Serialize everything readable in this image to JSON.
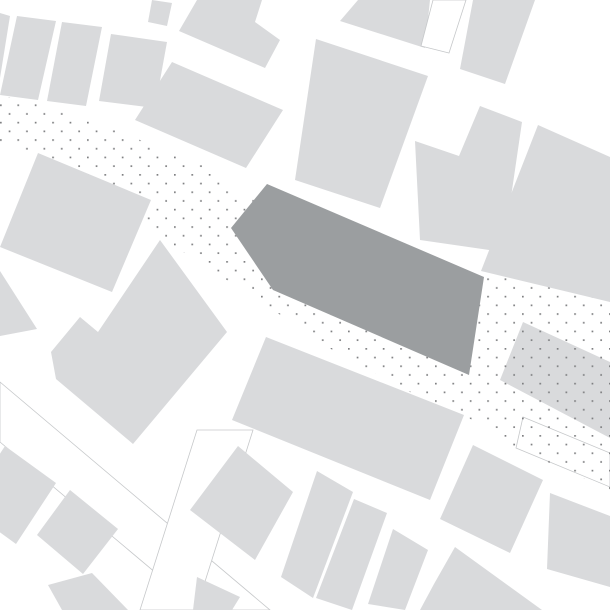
{
  "map": {
    "canvas": {
      "width": 610,
      "height": 610,
      "background": "#ffffff"
    },
    "colors": {
      "building_fill": "#d9dadc",
      "highlight_fill": "#9b9ea0",
      "outline_stroke": "#c6c8ca",
      "dot_color": "#7f8082",
      "background": "#ffffff"
    },
    "dot_pattern": {
      "cell_size": 17.4,
      "dot_size": 1.7,
      "stagger_offset": 8.7
    },
    "dotted_band": {
      "points": "0,95 70,112 140,140 205,166 232,190 480,272 610,293 610,490 516,448 464,415 410,392 340,355 270,308 160,237 130,215 70,168 0,143"
    },
    "highlight_building": {
      "id": "highlighted-building",
      "points": "267,184 484,277 469,375 273,290 231,228"
    },
    "dotted_building": {
      "id": "dotted-surface-building",
      "points": "523,322 610,362 610,438 500,380"
    },
    "outlined_white_building": {
      "id": "outlined-white-building",
      "points": "433,0 466,0 449,53 421,46"
    },
    "street_strips": [
      {
        "id": "street-strip-southwest",
        "points": "0,382 270,610 200,610 0,442"
      },
      {
        "id": "street-strip-south",
        "points": "197,430 253,430 196,610 140,610"
      },
      {
        "id": "street-strip-east",
        "points": "523,417 610,453 610,487 516,448"
      }
    ],
    "buildings": [
      {
        "id": "building-nw-1",
        "points": "0,13 10,16 0,78"
      },
      {
        "id": "building-nw-2",
        "points": "17,16 56,21 38,100 0,95"
      },
      {
        "id": "building-nw-3",
        "points": "62,22 102,27 86,106 47,101"
      },
      {
        "id": "building-nw-4",
        "points": "111,34 167,42 155,108 99,101"
      },
      {
        "id": "building-n-stub",
        "points": "152,0 172,3 167,26 148,22"
      },
      {
        "id": "building-n-notch",
        "points": "197,0 262,0 255,22 280,40 265,68 179,31"
      },
      {
        "id": "building-n-5",
        "points": "358,0 430,0 425,48 340,21"
      },
      {
        "id": "building-ne-1",
        "points": "473,0 535,0 505,84 460,69"
      },
      {
        "id": "building-center-west",
        "points": "172,62 283,110 246,168 135,120"
      },
      {
        "id": "building-center-north",
        "points": "316,39 428,76 380,208 295,180"
      },
      {
        "id": "building-center-east-L",
        "points": "415,141 459,156 480,106 522,122 503,252 420,240"
      },
      {
        "id": "building-east-large",
        "points": "538,125 610,157 610,302 481,271"
      },
      {
        "id": "building-west-large",
        "points": "38,153 151,200 112,292 0,247"
      },
      {
        "id": "building-west-sliver",
        "points": "0,271 37,329 0,336"
      },
      {
        "id": "building-sw-notched",
        "points": "160,240 227,332 133,444 56,379 51,352 80,317 98,332"
      },
      {
        "id": "building-south-of-highlight",
        "points": "266,337 464,415 430,500 232,420"
      },
      {
        "id": "building-sw-1",
        "points": "5,446 56,483 16,544 -35,507"
      },
      {
        "id": "building-sw-2",
        "points": "70,490 118,529 83,574 37,535"
      },
      {
        "id": "building-sw-3",
        "points": "48,585 92,573 128,610 62,610"
      },
      {
        "id": "building-s-stub",
        "points": "197,577 240,597 232,610 193,610"
      },
      {
        "id": "building-s-row-1",
        "points": "238,446 293,492 255,560 190,510"
      },
      {
        "id": "building-s-row-2",
        "points": "317,471 353,492 313,598 281,577"
      },
      {
        "id": "building-s-row-3",
        "points": "354,499 387,513 352,610 316,598"
      },
      {
        "id": "building-s-row-4",
        "points": "393,529 428,550 405,610 368,604"
      },
      {
        "id": "building-se-mid",
        "points": "473,445 543,480 510,553 440,519"
      },
      {
        "id": "building-se-right",
        "points": "550,493 610,516 610,587 547,569"
      },
      {
        "id": "building-se-bottom",
        "points": "455,547 542,610 420,610 434,584"
      }
    ]
  }
}
